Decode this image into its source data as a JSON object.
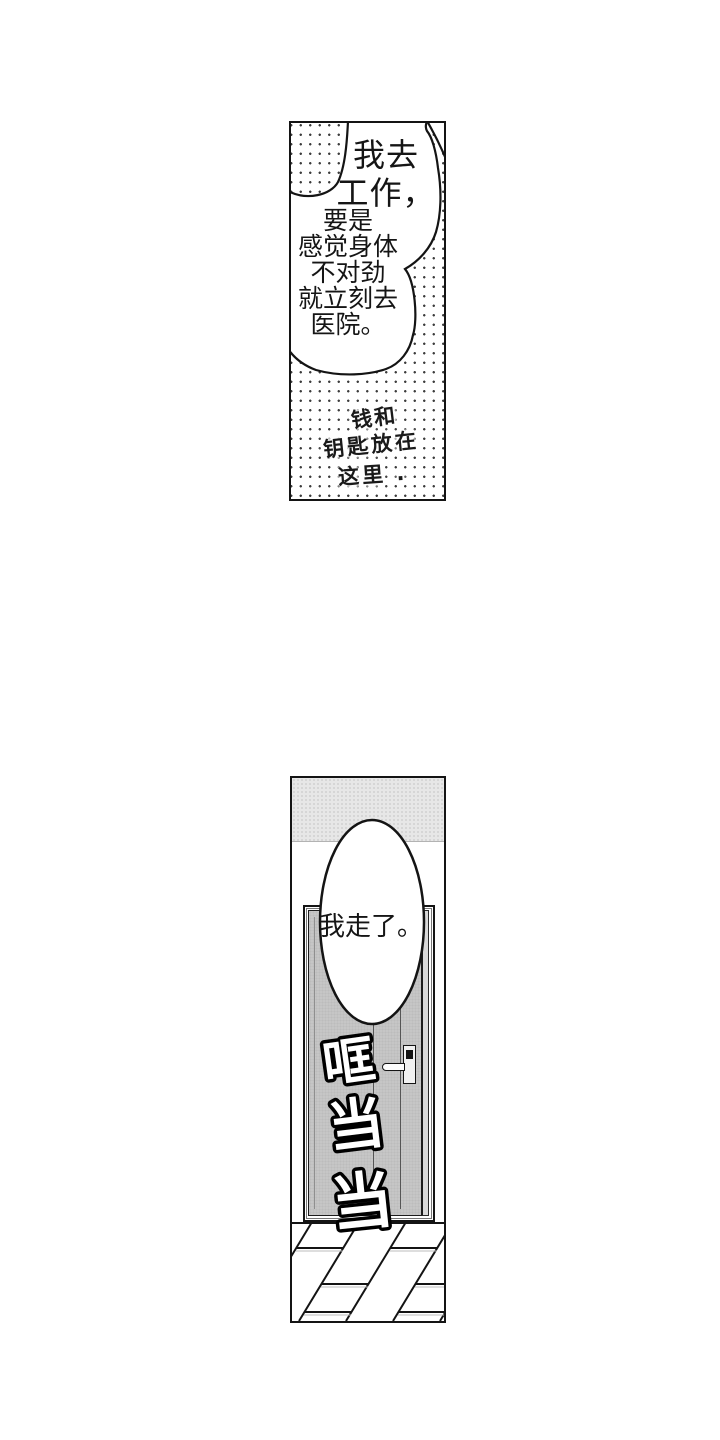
{
  "top_panel": {
    "bubble_text_right": [
      "我去",
      "工作，"
    ],
    "bubble_text_left": [
      "要是",
      "感觉身体",
      "不对劲",
      "就立刻去",
      "医院。"
    ],
    "note_lines": [
      "钱和",
      "钥匙放在",
      "这里 ."
    ]
  },
  "bottom_panel": {
    "bubble_text": "我走了。",
    "sfx_chars": [
      "哐",
      "当",
      "当"
    ]
  },
  "colors": {
    "ink": "#141414",
    "door_gray": "#c6c6c6",
    "door_edge_gray": "#d9d9d9",
    "wall_gray": "#e7e7e7",
    "halftone_dot": "#3c3c3c"
  }
}
